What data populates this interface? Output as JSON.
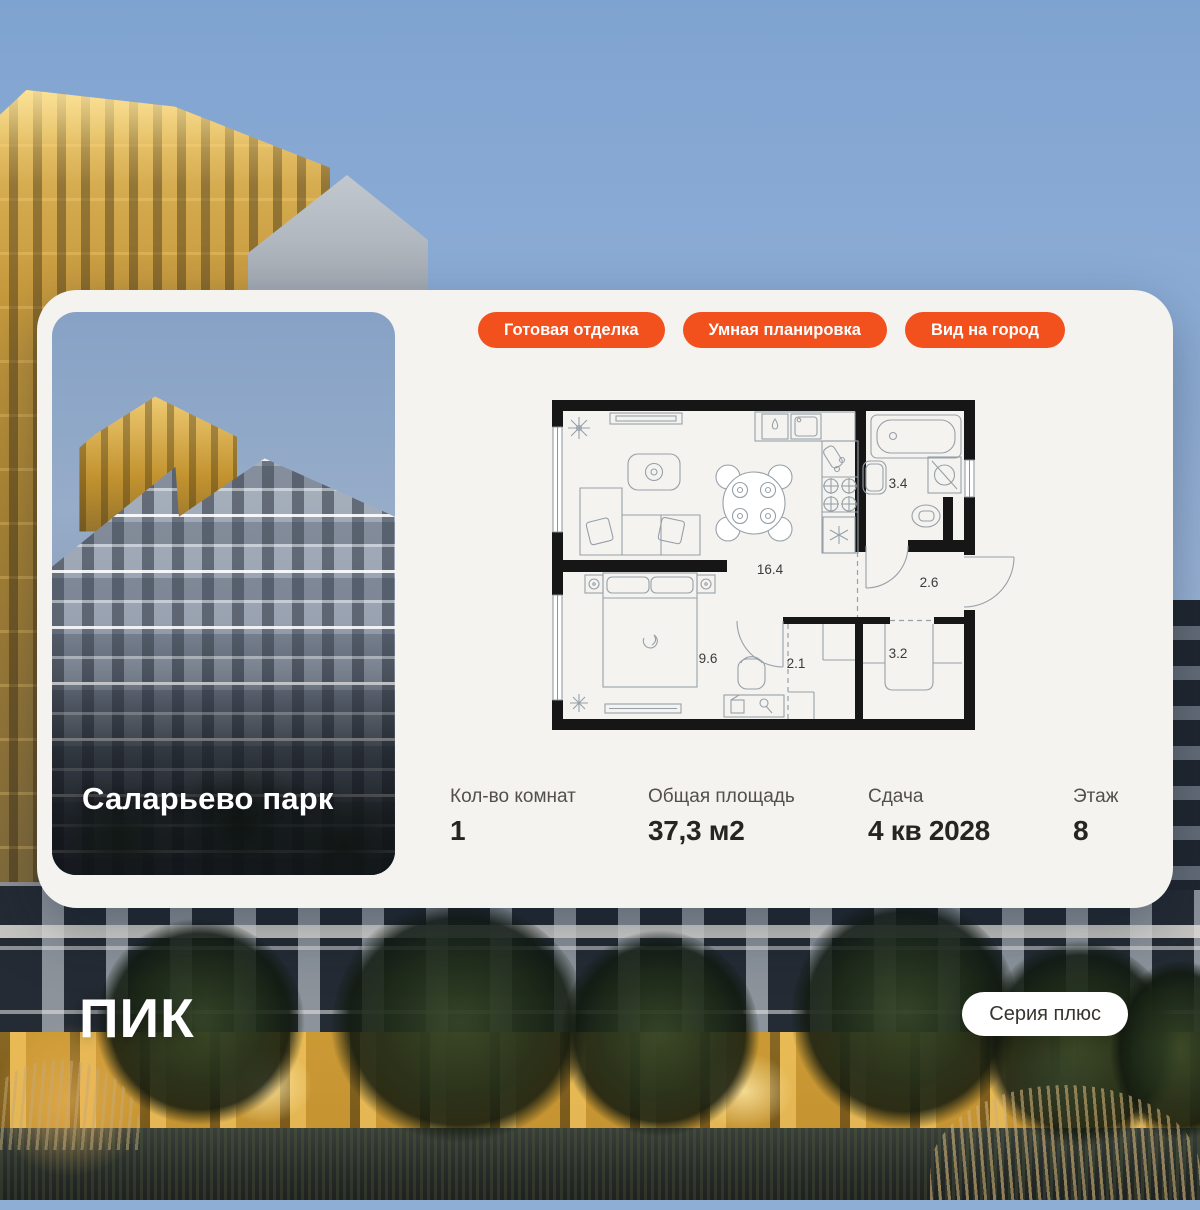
{
  "brand": {
    "logo_text": "ПИК"
  },
  "project": {
    "title": "Саларьево парк"
  },
  "badges": [
    {
      "label": "Готовая отделка"
    },
    {
      "label": "Умная планировка"
    },
    {
      "label": "Вид на город"
    }
  ],
  "series_badge": {
    "label": "Серия плюс"
  },
  "stats": [
    {
      "label": "Кол-во комнат",
      "value": "1"
    },
    {
      "label": "Общая площадь",
      "value": "37,3 м2"
    },
    {
      "label": "Сдача",
      "value": "4 кв 2028"
    },
    {
      "label": "Этаж",
      "value": "8"
    }
  ],
  "floorplan": {
    "rooms": [
      {
        "name": "living-kitchen",
        "area": "16.4"
      },
      {
        "name": "bathroom",
        "area": "3.4"
      },
      {
        "name": "hallway",
        "area": "2.6"
      },
      {
        "name": "bedroom",
        "area": "9.6"
      },
      {
        "name": "wardrobe",
        "area": "2.1"
      },
      {
        "name": "closet",
        "area": "3.2"
      }
    ]
  },
  "colors": {
    "accent": "#F2501C",
    "card_bg": "#F4F3F0"
  }
}
